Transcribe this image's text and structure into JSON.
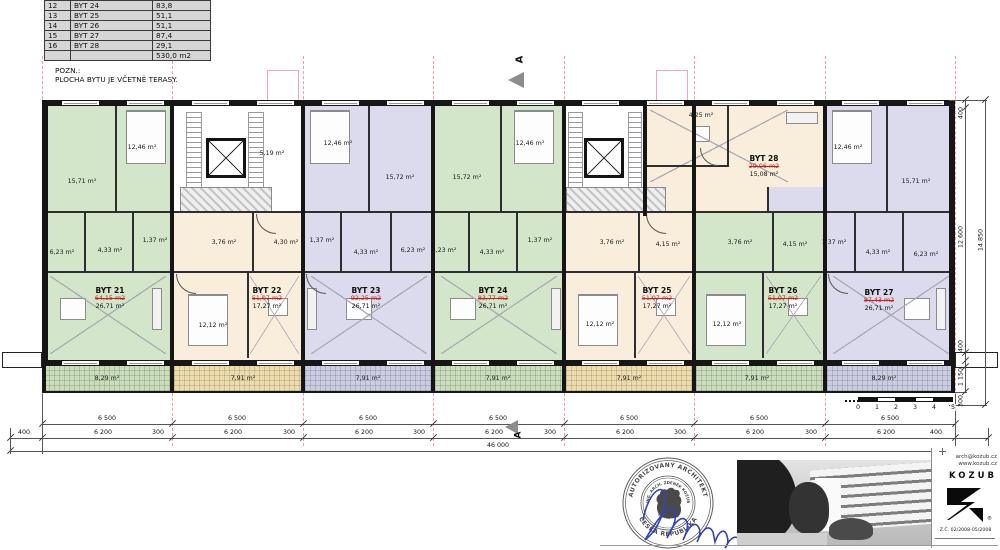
{
  "legend": {
    "rows": [
      [
        "12",
        "BYT 24",
        "83,8"
      ],
      [
        "13",
        "BYT 25",
        "51,1"
      ],
      [
        "14",
        "BYT 26",
        "51,1"
      ],
      [
        "15",
        "BYT 27",
        "87,4"
      ],
      [
        "16",
        "BYT 28",
        "29,1"
      ],
      [
        "",
        "",
        "530,0 m2"
      ]
    ]
  },
  "note": {
    "line1": "POZN.:",
    "line2": "PLOCHA BYTU JE VČETNĚ TERASY."
  },
  "section_marker": "A",
  "apartments": [
    {
      "name": "BYT 21",
      "total": "64,15 m2",
      "area": "26,71 m²"
    },
    {
      "name": "BYT 22",
      "total": "51,07 m2",
      "area": "17,27 m²"
    },
    {
      "name": "BYT 23",
      "total": "92,25 m2",
      "area": "26,71 m²"
    },
    {
      "name": "BYT 24",
      "total": "83,77 m2",
      "area": "26,71 m²"
    },
    {
      "name": "BYT 25",
      "total": "51,07 m2",
      "area": "17,27 m²"
    },
    {
      "name": "BYT 26",
      "total": "51,07 m2",
      "area": "17,27 m²"
    },
    {
      "name": "BYT 27",
      "total": "87,43 m2",
      "area": "26,71 m²"
    },
    {
      "name": "BYT 28",
      "total": "29,06 m2",
      "area": "15,08 m²"
    }
  ],
  "rooms": [
    "15,71 m²",
    "12,46 m²",
    "5,19 m²",
    "12,46 m²",
    "15,72 m²",
    "15,72 m²",
    "12,46 m²",
    "4,25 m²",
    "12,46 m²",
    "15,71 m²",
    "6,23 m²",
    "4,33 m²",
    "1,37 m²",
    "3,76 m²",
    "4,30 m²",
    "1,37 m²",
    "4,33 m²",
    "6,23 m²",
    "6,23 m²",
    "4,33 m²",
    "1,37 m²",
    "3,76 m²",
    "4,15 m²",
    "3,76 m²",
    "4,15 m²",
    "1,37 m²",
    "4,33 m²",
    "6,23 m²",
    "12,12 m²",
    "12,12 m²",
    "12,12 m²",
    "8,29 m²",
    "7,91 m²",
    "7,91 m²",
    "7,91 m²",
    "7,91 m²",
    "7,91 m²",
    "8,29 m²"
  ],
  "dims": {
    "bay": "6 500",
    "seg": "6 200",
    "gap": "300",
    "end": "400",
    "total": "46 000",
    "r1": "400",
    "r2": "12 600",
    "r3": "400",
    "r4": "1 150",
    "rtotal": "14 850",
    "r300": "300",
    "scale": [
      "0",
      "1",
      "2",
      "3",
      "4",
      "5"
    ]
  },
  "stamp": {
    "arc_top": "AUTORIZOVANÝ ARCHITEKT",
    "arc_bottom": "ČESKÁ REPUBLIKA",
    "inner_top": "ING. ARCH. ZDENĚK KOZUB",
    "inner_bottom": "ČKA 02 150"
  },
  "logo": {
    "email": "arch@kozub.cz",
    "web": "www.kozub.cz",
    "name": "KOZUB",
    "r_mark": "®",
    "reg": "Z.Č. 02/2008-05/2008"
  },
  "colors": {
    "apartment_green": "#d3e6c9",
    "apartment_cream": "#f8eedb",
    "apartment_purple": "#dcdbed",
    "terrace_green": "#cadebb",
    "terrace_cream": "#efdcad",
    "terrace_purple": "#cccce4",
    "red_area_text": "#c22222",
    "module_line_pink": "#e9a0a0",
    "signature_blue": "#3344bb"
  }
}
